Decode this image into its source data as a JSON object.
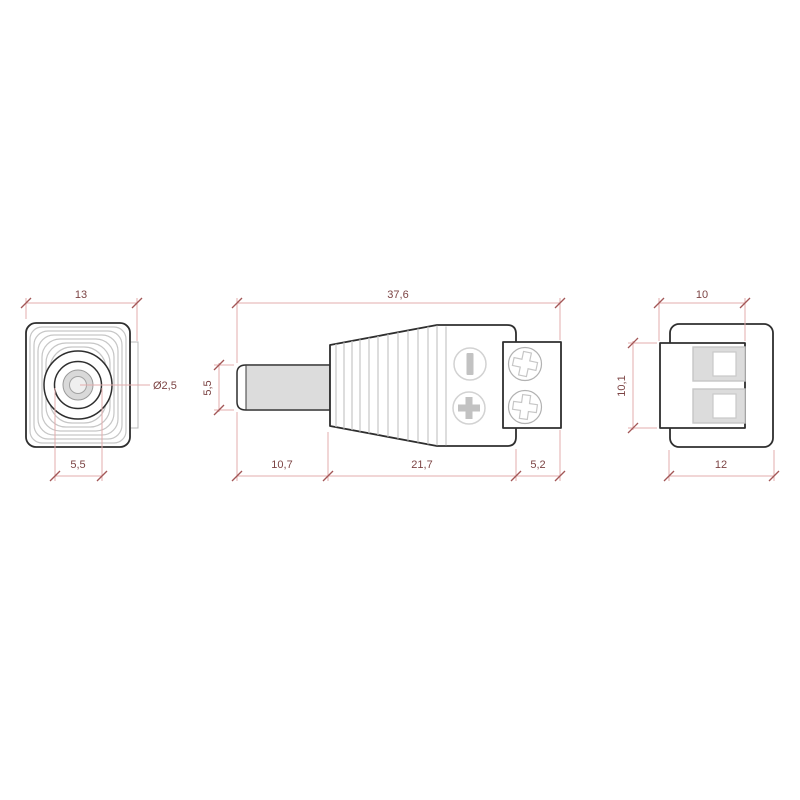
{
  "drawing": {
    "subject": "DC barrel power plug with screw terminal block, three orthographic views",
    "views": {
      "front": {
        "dims": {
          "width": "13",
          "pin_diameter": "Ø2,5",
          "barrel_diameter": "5,5"
        }
      },
      "side": {
        "dims": {
          "overall_length": "37,6",
          "barrel_diameter": "5,5",
          "barrel_length": "10,7",
          "body_length": "21,7",
          "terminal_depth": "5,2"
        },
        "icons": {
          "polarity_negative": "minus-icon",
          "polarity_positive": "plus-icon",
          "screws": "phillips-screw-icon"
        }
      },
      "rear": {
        "dims": {
          "block_width": "10",
          "block_height": "10,1",
          "body_width": "12"
        }
      }
    },
    "colors": {
      "background": "#ffffff",
      "outline": "#2e2e2e",
      "detail_gray": "#c6c6c6",
      "fill_gray": "#dcdcdc",
      "dim_line": "#e3adad",
      "dim_tick": "#a35757",
      "dim_text": "#7c4444"
    }
  }
}
